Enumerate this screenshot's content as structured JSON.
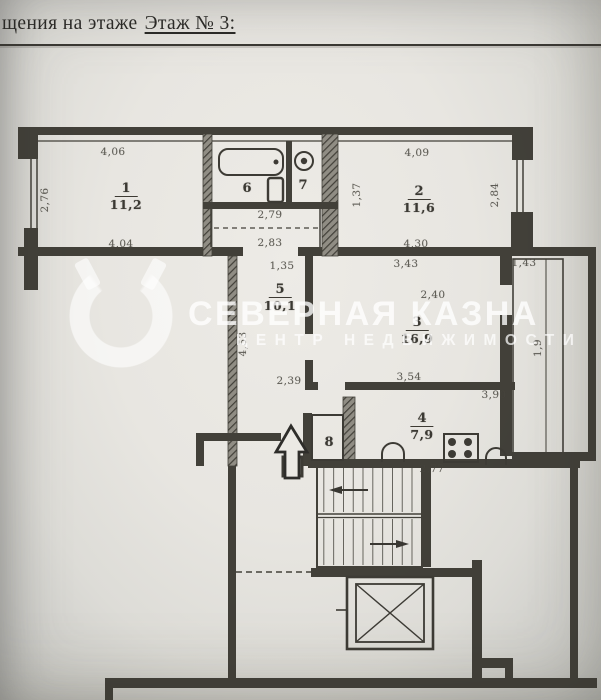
{
  "header": {
    "prefix": "щения на этаже",
    "floor": "Этаж № 3:"
  },
  "watermark": {
    "title": "СЕВЕРНАЯ КАЗНА",
    "subtitle": "ЦЕНТР НЕДВИЖИМОСТИ"
  },
  "plan": {
    "rooms": [
      {
        "num": "1",
        "area": "11,2"
      },
      {
        "num": "2",
        "area": "11,6"
      },
      {
        "num": "3",
        "area": "16,9"
      },
      {
        "num": "4",
        "area": "7,9"
      },
      {
        "num": "5",
        "area": "10,1"
      },
      {
        "num": "6",
        "area": ""
      },
      {
        "num": "7",
        "area": ""
      },
      {
        "num": "8",
        "area": ""
      }
    ],
    "dimensions": {
      "room1_top": "4,06",
      "room1_bottom": "4,04",
      "room1_left": "2,76",
      "room2_top": "4,09",
      "room2_bottom": "4,30",
      "room2_right": "2,84",
      "room2_left": "1,37",
      "bath_width": "2,79",
      "bath_width2": "2,83",
      "hall_top": "1,35",
      "room3_top": "3,43",
      "room3_height": "2,40",
      "corridor_left": "4,53",
      "hall_bottom": "2,39",
      "room3_bottom_left": "3,54",
      "room3_bottom_right": "3,90",
      "kitchen_bottom": "2,77",
      "loggia_top": "1,43",
      "loggia_side": "1,9"
    }
  }
}
